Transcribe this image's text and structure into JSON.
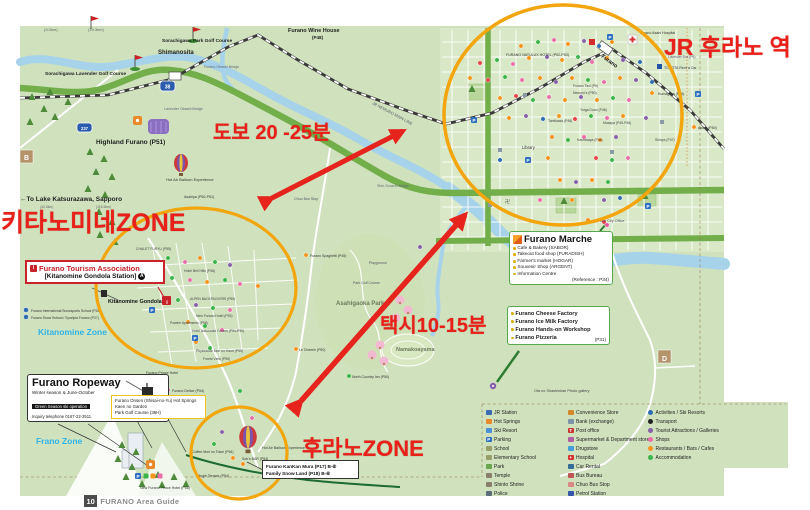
{
  "annotations": {
    "jr": "JR 후라노 역",
    "walk": "도보 20 -25분",
    "kitanomine": "키타노미네ZONE",
    "taxi": "택시10-15분",
    "furano": "후라노ZONE"
  },
  "boxes": {
    "tourism": {
      "title": "Furano Tourism Association",
      "subtitle": "[Kitanomine Gondola Station]",
      "info_glyph": "i",
      "circle_glyph": "A"
    },
    "ropeway": {
      "title": "Furano Ropeway",
      "line1": "Winter season & June-October",
      "bar": "Green Season ski operation",
      "line2": "Inquiry telephone 0167-22-3511"
    },
    "onsen": {
      "lines": [
        "Furano Onsen (Shisai-no-Yu) Hot Springs",
        "Kaen no Garden",
        "Park Golf Course (36H)"
      ]
    },
    "kankan": {
      "lines": [
        "Furano KanKan Mura (P17)  B-⑥",
        "Family Snow Land  (P18)  B-⑥"
      ]
    },
    "marche": {
      "title": "Furano Marche",
      "items": [
        "Cafe & Bakery (SABOR)",
        "Takeout food shop (FURADISH)",
        "Farmer's market (HOGAR)",
        "Souvenir Shop (ARGENT)",
        "Information Centre"
      ],
      "reference": "(Reference : P34)"
    },
    "factory": {
      "items": [
        "Furano Cheese Factory",
        "Furano Ice Milk Factory",
        "Furano Hands-on Workshop",
        "Furano Pizzeria"
      ],
      "reference": "(P31)"
    }
  },
  "legend": {
    "col1": [
      {
        "label": "JR Station",
        "color": "#3a6bb5"
      },
      {
        "label": "Hot Springs",
        "color": "#e98b2d"
      },
      {
        "label": "Ski Resort",
        "color": "#4a90d9"
      },
      {
        "label": "Parking",
        "color": "#2f6fc1",
        "glyph": "P"
      },
      {
        "label": "School",
        "color": "#97a06b"
      },
      {
        "label": "Elementary School",
        "color": "#97a06b"
      },
      {
        "label": "Park",
        "color": "#6aa84f"
      },
      {
        "label": "Temple",
        "color": "#8a7f6a"
      },
      {
        "label": "Shinto Shrine",
        "color": "#8a7f6a"
      },
      {
        "label": "Police",
        "color": "#5a6b7a"
      }
    ],
    "col2": [
      {
        "label": "Convenience Store",
        "color": "#d4882a"
      },
      {
        "label": "Bank (exchange)",
        "color": "#7f94a8"
      },
      {
        "label": "Post office",
        "color": "#cc3333",
        "glyph": "T"
      },
      {
        "label": "Supermarket & Department store",
        "color": "#b05fa0"
      },
      {
        "label": "Drugstore",
        "color": "#44a0d8"
      },
      {
        "label": "Hospital",
        "color": "#d43333",
        "glyph": "+"
      },
      {
        "label": "Car Rental",
        "color": "#336b99"
      },
      {
        "label": "Bus Bureau",
        "color": "#c05555"
      },
      {
        "label": "Chuo Bus Stop",
        "color": "#dd8888"
      },
      {
        "label": "Petrol Station",
        "color": "#3355aa"
      }
    ],
    "col3": [
      {
        "label": "Activities / Ski Resorts",
        "color": "#2e6db4"
      },
      {
        "label": "Transport",
        "color": "#222222"
      },
      {
        "label": "Tourist Attractions / Galleries",
        "color": "#8660a8"
      },
      {
        "label": "Shops",
        "color": "#ec6ea9"
      },
      {
        "label": "Restaurants / Bars / Cafes",
        "color": "#f7941d"
      },
      {
        "label": "Accommodation",
        "color": "#39b54a"
      }
    ]
  },
  "badge": {
    "number": "10",
    "label": "FURANO Area Guide"
  },
  "map_labels": [
    {
      "n": "distance-1",
      "text": "(3.0km)",
      "x": 44,
      "y": 31,
      "fs": 4,
      "c": "#666"
    },
    {
      "n": "distance-2",
      "text": "(19.3km)",
      "x": 88,
      "y": 31,
      "fs": 4,
      "c": "#666"
    },
    {
      "n": "golf-course-1",
      "text": "Sorachigawa Lavender Golf Course",
      "x": 45,
      "y": 75,
      "fs": 4.8,
      "c": "#222",
      "b": 1
    },
    {
      "n": "golf-course-2",
      "text": "Sorachigawa Park Golf Course",
      "x": 162,
      "y": 42,
      "fs": 4.8,
      "c": "#222",
      "b": 1
    },
    {
      "n": "shimanosita-station",
      "text": "Shimanosita",
      "x": 158,
      "y": 54,
      "fs": 6,
      "c": "#222",
      "b": 1
    },
    {
      "n": "wine-house",
      "text": "Furano Wine House",
      "x": 288,
      "y": 32,
      "fs": 5.5,
      "c": "#222",
      "b": 1
    },
    {
      "n": "wine-house-page",
      "text": "(P48)",
      "x": 312,
      "y": 39,
      "fs": 4.5,
      "c": "#222",
      "b": 1
    },
    {
      "n": "bridge-furano-obashi",
      "text": "Furano Obashi Bridge",
      "x": 204,
      "y": 68,
      "fs": 3.6,
      "c": "#667"
    },
    {
      "n": "bridge-lavender-obashi",
      "text": "Lavender Obashi Bridge",
      "x": 164,
      "y": 110,
      "fs": 3.6,
      "c": "#667"
    },
    {
      "n": "jr-nemuro-line",
      "text": "JR NEMURO MAIN LINE",
      "x": 372,
      "y": 104,
      "fs": 4,
      "c": "#556",
      "r": 28
    },
    {
      "n": "highland-furano",
      "text": "Highland Furano (P51)",
      "x": 96,
      "y": 144,
      "fs": 6.5,
      "c": "#222",
      "b": 1
    },
    {
      "n": "balloon-experience-1",
      "text": "Hot Air Balloon Experience",
      "x": 166,
      "y": 181,
      "fs": 4,
      "c": "#333"
    },
    {
      "n": "asahiya",
      "text": "Asahiya (P50-P51)",
      "x": 184,
      "y": 198,
      "fs": 3.6,
      "c": "#333"
    },
    {
      "n": "to-katsurazawa",
      "text": "←To Lake Katsurazawa, Sapporo",
      "x": 20,
      "y": 201,
      "fs": 6.5,
      "c": "#222",
      "b": 1
    },
    {
      "n": "distance-3",
      "text": "(40.6km)",
      "x": 40,
      "y": 208,
      "fs": 3.4,
      "c": "#666"
    },
    {
      "n": "distance-4",
      "text": "(115.5km)",
      "x": 96,
      "y": 208,
      "fs": 3.4,
      "c": "#666"
    },
    {
      "n": "bridge-shin-sorachi",
      "text": "Shin-Sorachi Bridge",
      "x": 377,
      "y": 187,
      "fs": 3.6,
      "c": "#667"
    },
    {
      "n": "chuo-bus-stop",
      "text": "Chuo Bus Stop",
      "x": 294,
      "y": 200,
      "fs": 3.6,
      "c": "#556"
    },
    {
      "n": "furano-station",
      "text": "Furano",
      "x": 601,
      "y": 57,
      "fs": 5.5,
      "c": "#111",
      "b": 1,
      "r": 36
    },
    {
      "n": "furano-hospital",
      "text": "Furano Asahi Hospital",
      "x": 640,
      "y": 34,
      "fs": 3.6,
      "c": "#333"
    },
    {
      "n": "toyota-rentacar",
      "text": "TOYOTA Rent a Car",
      "x": 664,
      "y": 69,
      "fs": 3.6,
      "c": "#334"
    },
    {
      "n": "lavender-bus",
      "text": "Lavender Bus (P6)",
      "x": 668,
      "y": 58,
      "fs": 3.3,
      "c": "#556"
    },
    {
      "n": "kumagera",
      "text": "Kumagera (P46)",
      "x": 658,
      "y": 95,
      "fs": 3.6,
      "c": "#333"
    },
    {
      "n": "akiba",
      "text": "Akiba (P50)",
      "x": 698,
      "y": 129,
      "fs": 3.6,
      "c": "#333"
    },
    {
      "n": "natulux-hotel",
      "text": "FURANO NATULUX HOTEL (P52-P53)",
      "x": 506,
      "y": 56,
      "fs": 3.6,
      "c": "#333"
    },
    {
      "n": "furano-taxi",
      "text": "Furano Taxi (P6)",
      "x": 573,
      "y": 87,
      "fs": 3.4,
      "c": "#444"
    },
    {
      "n": "nemuros",
      "text": "Nemuro's (P50)",
      "x": 573,
      "y": 94,
      "fs": 3.4,
      "c": "#444"
    },
    {
      "n": "yuiga-doon",
      "text": "Yuiga Doon (P46)",
      "x": 580,
      "y": 111,
      "fs": 3.4,
      "c": "#444"
    },
    {
      "n": "tamikawa",
      "text": "Tamikawa (P46)",
      "x": 548,
      "y": 122,
      "fs": 3.4,
      "c": "#444"
    },
    {
      "n": "masaya",
      "text": "Masaya (P45-P46)",
      "x": 603,
      "y": 124,
      "fs": 3.4,
      "c": "#444"
    },
    {
      "n": "kashiwaya",
      "text": "Kashiwaya (P46)",
      "x": 577,
      "y": 141,
      "fs": 3.4,
      "c": "#444"
    },
    {
      "n": "shinya",
      "text": "Shinya (P47)",
      "x": 655,
      "y": 141,
      "fs": 3.4,
      "c": "#444"
    },
    {
      "n": "library",
      "text": "Library",
      "x": 522,
      "y": 149,
      "fs": 4.2,
      "c": "#333"
    },
    {
      "n": "city-office",
      "text": "Furano City Office",
      "x": 594,
      "y": 222,
      "fs": 3.8,
      "c": "#556"
    },
    {
      "n": "temple-mark",
      "text": "卍",
      "x": 505,
      "y": 203,
      "fs": 5,
      "c": "#555"
    },
    {
      "n": "kitanomine-gondola",
      "text": "Kitanomine Gondola",
      "x": 108,
      "y": 303,
      "fs": 5.5,
      "c": "#111",
      "b": 1
    },
    {
      "n": "snowsports-school",
      "text": "Furano International Snowsports School (P26)",
      "x": 31,
      "y": 312,
      "fs": 3.4,
      "c": "#333"
    },
    {
      "n": "snow-school",
      "text": "Furano Snow School / Sportpia Furano (P27)",
      "x": 31,
      "y": 319,
      "fs": 3.4,
      "c": "#333"
    },
    {
      "n": "kitanomine-zone-label",
      "text": "Kitanomine Zone",
      "x": 38,
      "y": 335,
      "fs": 8.5,
      "c": "#2fb3e8",
      "b": 1
    },
    {
      "n": "chalet-furyu",
      "text": "CHALET FURYU (P55)",
      "x": 136,
      "y": 250,
      "fs": 3.4,
      "c": "#444"
    },
    {
      "n": "hotel-bell-hills",
      "text": "Hotel Bell Hills (P56)",
      "x": 184,
      "y": 272,
      "fs": 3.4,
      "c": "#444"
    },
    {
      "n": "alpen-backpackers",
      "text": "ALPEN BACKPACKERS (P55)",
      "x": 190,
      "y": 300,
      "fs": 3.3,
      "c": "#444"
    },
    {
      "n": "new-furano-hotel",
      "text": "New Furano Hotel (P53)",
      "x": 196,
      "y": 317,
      "fs": 3.4,
      "c": "#444"
    },
    {
      "n": "powder-apartments",
      "text": "Powder Apartments (P56)",
      "x": 170,
      "y": 324,
      "fs": 3.3,
      "c": "#444"
    },
    {
      "n": "hotel-naturwald",
      "text": "Hotel Naturwald Furano (P54-P55)",
      "x": 192,
      "y": 332,
      "fs": 3.4,
      "c": "#444"
    },
    {
      "n": "phytoncide",
      "text": "Phytoncide Mori no Kaori (P55)",
      "x": 196,
      "y": 352,
      "fs": 3.4,
      "c": "#444"
    },
    {
      "n": "forest-view",
      "text": "Forest View (P55)",
      "x": 203,
      "y": 360,
      "fs": 3.4,
      "c": "#444"
    },
    {
      "n": "furano-ski-area",
      "text": "Furano Ski Area",
      "x": 62,
      "y": 391,
      "fs": 8.5,
      "c": "#1f3a6e",
      "b": 1
    },
    {
      "n": "furano-prince-hotel",
      "text": "Furano Prince Hotel",
      "x": 146,
      "y": 374,
      "fs": 3.6,
      "c": "#333"
    },
    {
      "n": "furano-delice",
      "text": "Furano Delice (P54)",
      "x": 172,
      "y": 392,
      "fs": 3.6,
      "c": "#333"
    },
    {
      "n": "frano-zone-label",
      "text": "Frano Zone",
      "x": 36,
      "y": 444,
      "fs": 8.5,
      "c": "#2fb3e8",
      "b": 1
    },
    {
      "n": "new-prince-hotel",
      "text": "New Furano Prince Hotel (P56)",
      "x": 140,
      "y": 489,
      "fs": 3.6,
      "c": "#333"
    },
    {
      "n": "balloon-experience-2",
      "text": "Hot Air Balloon Experience",
      "x": 262,
      "y": 449,
      "fs": 3.6,
      "c": "#333"
    },
    {
      "n": "coffee-mori-no-tokei",
      "text": "Coffee Mori no Tokei (P54)",
      "x": 192,
      "y": 453,
      "fs": 3.5,
      "c": "#333"
    },
    {
      "n": "sohs-bar",
      "text": "Soh's BAR (P54)",
      "x": 242,
      "y": 460,
      "fs": 3.5,
      "c": "#333"
    },
    {
      "n": "ningle-terrace",
      "text": "Ningle Terrace (P54)",
      "x": 197,
      "y": 477,
      "fs": 3.5,
      "c": "#333"
    },
    {
      "n": "asahigaoka-park",
      "text": "Asahigaoka Park",
      "x": 336,
      "y": 305,
      "fs": 6,
      "c": "#6b7a5e",
      "b": 1
    },
    {
      "n": "namakoayama",
      "text": "Namakoayama",
      "x": 396,
      "y": 351,
      "fs": 5.5,
      "c": "#6b7a5e",
      "b": 1
    },
    {
      "n": "north-country-inn",
      "text": "North Country Inn (P50)",
      "x": 352,
      "y": 378,
      "fs": 3.5,
      "c": "#333"
    },
    {
      "n": "le-chemin",
      "text": "Le Chemin (P50)",
      "x": 299,
      "y": 351,
      "fs": 3.5,
      "c": "#333"
    },
    {
      "n": "furano-spaghetti",
      "text": "Furano Spaghetti (P45)",
      "x": 310,
      "y": 257,
      "fs": 3.5,
      "c": "#333"
    },
    {
      "n": "park-golf-course",
      "text": "Park Golf Course",
      "x": 353,
      "y": 284,
      "fs": 3.5,
      "c": "#556"
    },
    {
      "n": "playground",
      "text": "Playground",
      "x": 369,
      "y": 264,
      "fs": 3.5,
      "c": "#556"
    },
    {
      "n": "photo-gallery",
      "text": "Ota no Shashinkan Photo gallery",
      "x": 534,
      "y": 392,
      "fs": 3.8,
      "c": "#444"
    },
    {
      "n": "route-38",
      "text": "38",
      "x": 167.5,
      "y": 88.5,
      "fs": 5,
      "c": "#fff",
      "b": 1,
      "a": "middle"
    },
    {
      "n": "route-237",
      "text": "237",
      "x": 84.5,
      "y": 130,
      "fs": 4.2,
      "c": "#fff",
      "b": 1,
      "a": "middle"
    },
    {
      "n": "grid-cell-b",
      "text": "B",
      "x": 26.5,
      "y": 160,
      "fs": 7,
      "c": "#fff",
      "b": 1,
      "a": "middle"
    },
    {
      "n": "grid-cell-d",
      "text": "D",
      "x": 664.5,
      "y": 361,
      "fs": 7,
      "c": "#fff",
      "b": 1,
      "a": "middle"
    },
    {
      "n": "gondola-info",
      "text": "i",
      "x": 167,
      "y": 304,
      "fs": 5.5,
      "c": "#fff",
      "b": 1,
      "a": "middle"
    }
  ]
}
